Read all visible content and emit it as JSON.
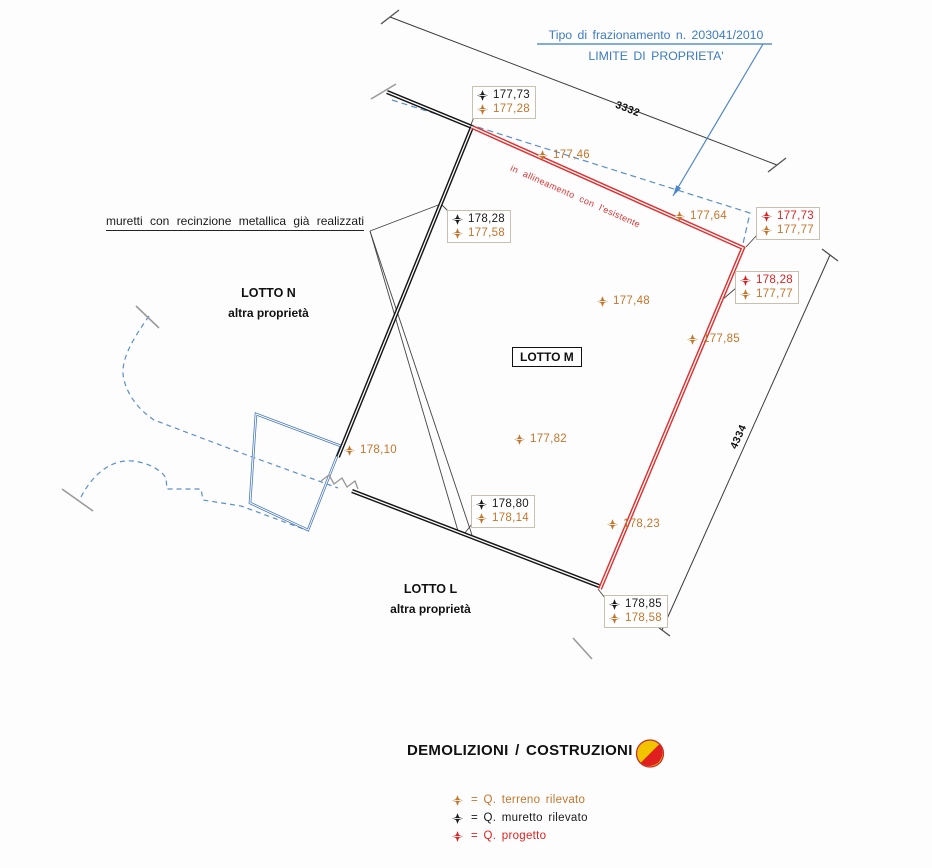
{
  "drawing": {
    "title_line1": "Tipo di frazionamento n. 203041/2010",
    "title_line2": "LIMITE DI PROPRIETA'",
    "note_muretti": "muretti con recinzione metallica già realizzati",
    "note_allineamento": "in allineamento con l'esistente"
  },
  "lots": {
    "n": {
      "name": "LOTTO N",
      "sub": "altra proprietà"
    },
    "m": {
      "name": "LOTTO M"
    },
    "l": {
      "name": "LOTTO L",
      "sub": "altra proprietà"
    }
  },
  "dimensions": {
    "top_edge": "3332",
    "right_edge": "4334"
  },
  "elevation_boxes": [
    {
      "rows": [
        {
          "type": "muretto",
          "value": "177,73"
        },
        {
          "type": "terreno",
          "value": "177,28"
        }
      ]
    },
    {
      "rows": [
        {
          "type": "muretto",
          "value": "178,28"
        },
        {
          "type": "terreno",
          "value": "177,58"
        }
      ]
    },
    {
      "rows": [
        {
          "type": "progetto",
          "value": "177,73"
        },
        {
          "type": "terreno",
          "value": "177,77"
        }
      ]
    },
    {
      "rows": [
        {
          "type": "progetto",
          "value": "178,28"
        },
        {
          "type": "terreno",
          "value": "177,77"
        }
      ]
    },
    {
      "rows": [
        {
          "type": "muretto",
          "value": "178,80"
        },
        {
          "type": "terreno",
          "value": "178,14"
        }
      ]
    },
    {
      "rows": [
        {
          "type": "muretto",
          "value": "178,85"
        },
        {
          "type": "terreno",
          "value": "178,58"
        }
      ]
    }
  ],
  "elevation_points": [
    {
      "type": "terreno",
      "value": "177,46"
    },
    {
      "type": "terreno",
      "value": "177,64"
    },
    {
      "type": "terreno",
      "value": "177,48"
    },
    {
      "type": "terreno",
      "value": "177,85"
    },
    {
      "type": "terreno",
      "value": "178,10"
    },
    {
      "type": "terreno",
      "value": "177,82"
    },
    {
      "type": "terreno",
      "value": "178,23"
    }
  ],
  "legend": {
    "title": "DEMOLIZIONI / COSTRUZIONI",
    "items": [
      {
        "type": "terreno",
        "label": "= Q. terreno rilevato"
      },
      {
        "type": "muretto",
        "label": "= Q. muretto rilevato"
      },
      {
        "type": "progetto",
        "label": "= Q. progetto"
      }
    ]
  },
  "colors": {
    "terreno": "#C4752B",
    "muretto": "#1A1A1A",
    "progetto": "#E01F1F",
    "property_line_blue": "#4E86C6",
    "project_line_red": "#E03030",
    "legend_yellow": "#F2C400"
  }
}
